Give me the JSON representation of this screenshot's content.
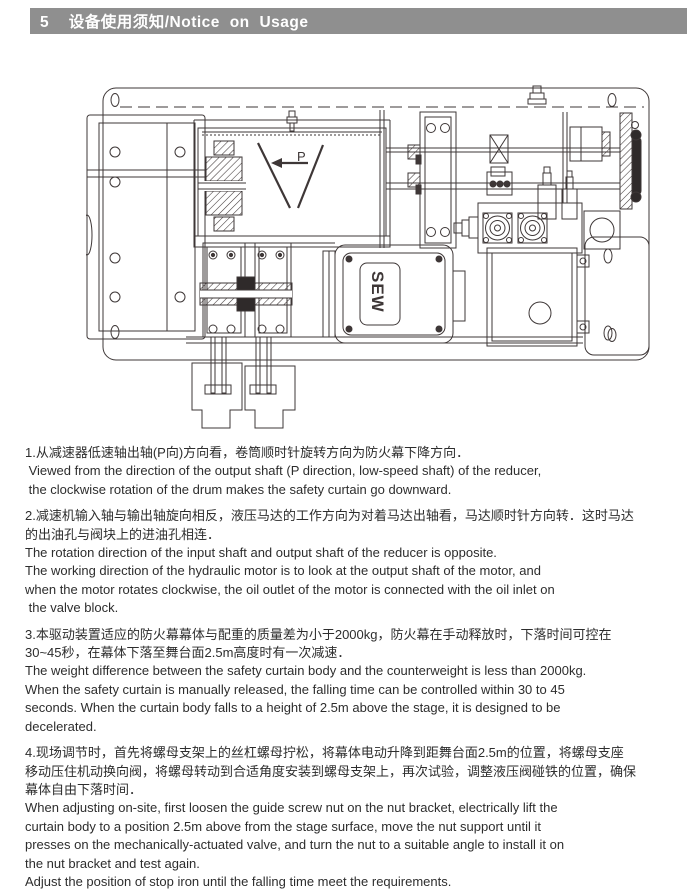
{
  "header": {
    "title": "5  设备使用须知/Notice on Usage"
  },
  "drawing": {
    "p_label": "P",
    "motor_logo": "SEW"
  },
  "notices": [
    {
      "lines": [
        "1.从减速器低速轴出轴(P向)方向看，卷筒顺时针旋转方向为防火幕下降方向．",
        " Viewed from the direction of the output shaft (P direction, low-speed shaft) of the reducer,",
        " the clockwise rotation of the drum makes the safety curtain go downward."
      ]
    },
    {
      "lines": [
        "2.减速机输入轴与输出轴旋向相反，液压马达的工作方向为对着马达出轴看，马达顺时针方向转．这时马达",
        "的出油孔与阀块上的进油孔相连．",
        "The rotation direction of the input shaft and output shaft of the reducer is opposite.",
        "The working direction of the hydraulic motor is to look at the output shaft of the motor, and",
        "when the motor rotates clockwise, the oil outlet of the motor is connected with the oil inlet on",
        " the valve block."
      ]
    },
    {
      "lines": [
        "3.本驱动装置适应的防火幕幕体与配重的质量差为小于2000kg，防火幕在手动释放时，下落时间可控在",
        "30~45秒，在幕体下落至舞台面2.5m高度时有一次减速．",
        "The weight difference between the safety curtain body and the counterweight is less than 2000kg.",
        "When the safety curtain is manually released, the falling time can be controlled within 30 to 45",
        "seconds. When the curtain body falls to a height of 2.5m above the stage, it is designed to be",
        "decelerated."
      ]
    },
    {
      "lines": [
        "4.现场调节时，首先将螺母支架上的丝杠螺母拧松，将幕体电动升降到距舞台面2.5m的位置，将螺母支座",
        "移动压住机动换向阀，将螺母转动到合适角度安装到螺母支架上，再次试验，调整液压阀碰铁的位置，确保",
        "幕体自由下落时间．",
        "When adjusting on-site, first loosen the guide screw nut on the nut bracket, electrically lift the",
        "curtain body to a position 2.5m above from the stage surface, move the nut support until it",
        "presses on the mechanically-actuated valve, and turn the nut to a suitable angle to install it on",
        "the nut bracket and test again.",
        "Adjust the position of stop iron until the falling time meet the requirements."
      ]
    }
  ]
}
